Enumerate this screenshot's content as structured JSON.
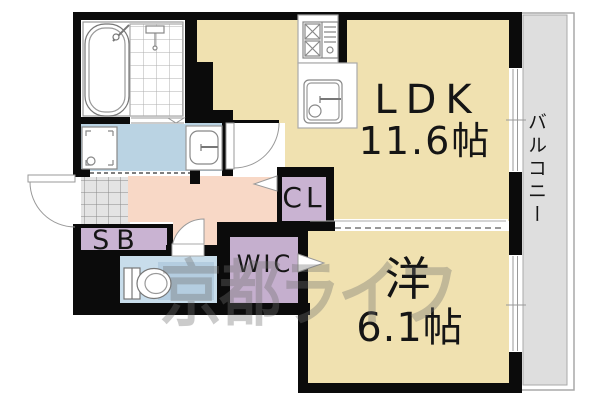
{
  "plan": {
    "rooms": {
      "ldk": {
        "label": "LDK",
        "size": "11.6帖"
      },
      "western": {
        "label": "洋",
        "size": "6.1帖"
      },
      "balcony": {
        "label": "バルコニー"
      },
      "closet": {
        "label": "CL"
      },
      "walk_in_closet": {
        "label": "WIC"
      },
      "shoe_box": {
        "label": "SB"
      }
    },
    "watermark": "京都ライフ",
    "colors": {
      "room_floor": "#F0E1B0",
      "hallway": "#F8D8C6",
      "washroom": "#BAD3E3",
      "toilet": "#C8DDEB",
      "closet": "#C9B3D2",
      "wic": "#C5AFCE",
      "balcony": "#DEDEDE",
      "entry_tile": "#E4E4E4",
      "wall": "#0B0B0B"
    }
  }
}
